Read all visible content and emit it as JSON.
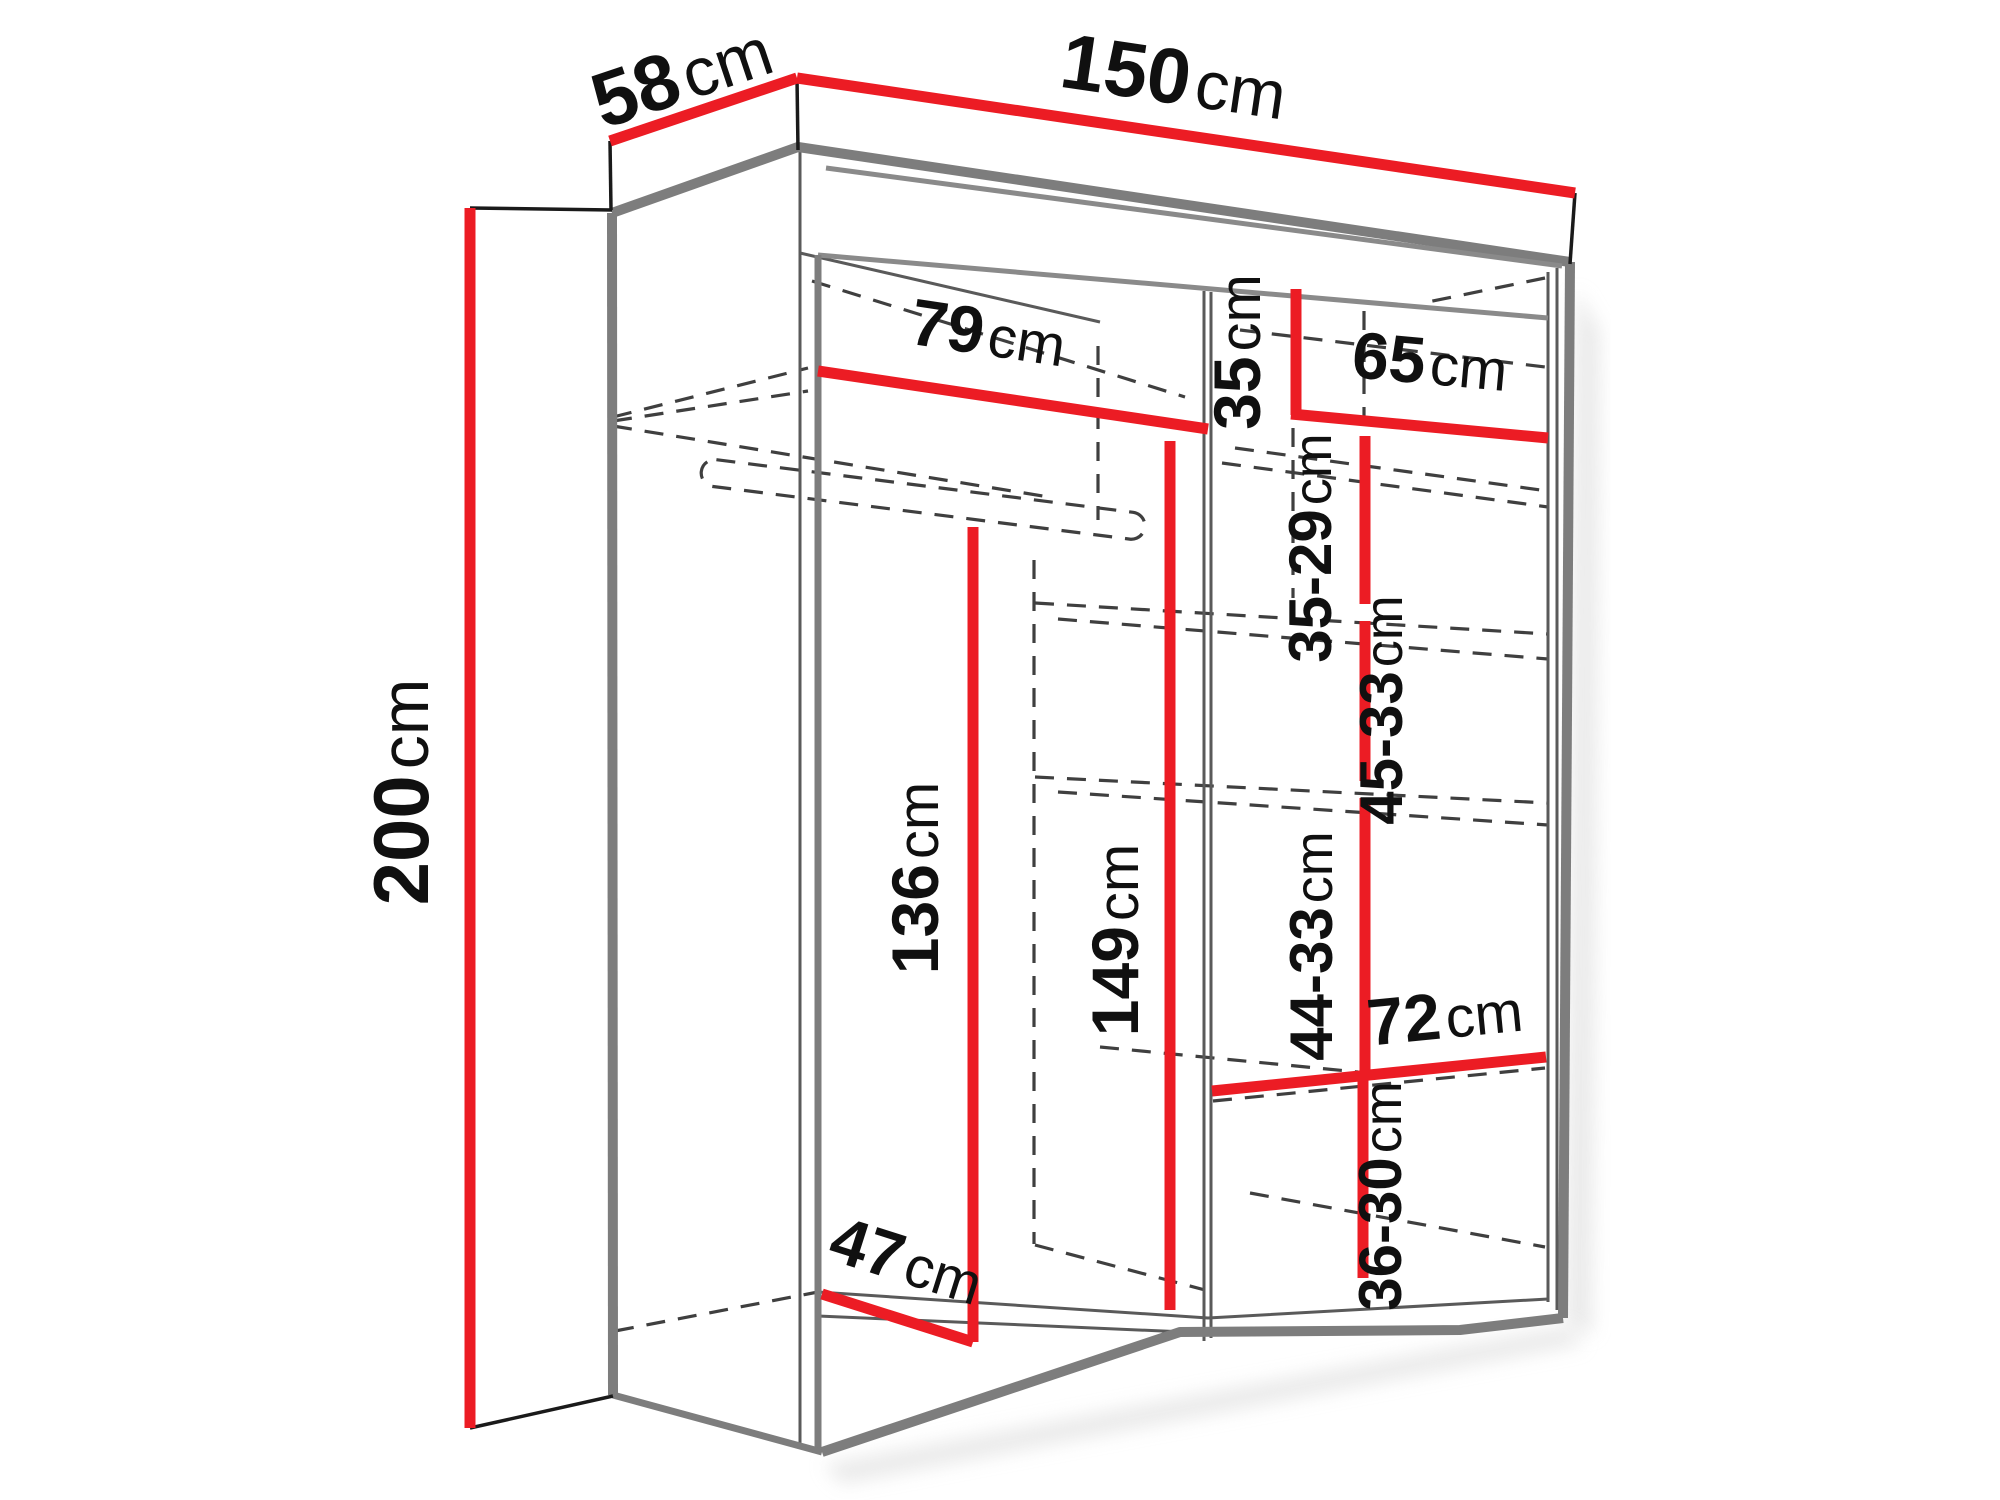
{
  "figure": {
    "type": "furniture-dimension-diagram",
    "subject": "two-door sliding wardrobe with interior shelf and hanging-rail dimensions",
    "background": "#ffffff"
  },
  "colors": {
    "dimension_line": "#ec1c24",
    "cabinet_edge": "#7d7d7d",
    "hidden_edge": "#3f3f3f",
    "text": "#101010"
  },
  "dims": {
    "depth58": {
      "value": "58",
      "unit": "cm"
    },
    "width150": {
      "value": "150",
      "unit": "cm"
    },
    "height200": {
      "value": "200",
      "unit": "cm"
    },
    "shelf79": {
      "value": "79",
      "unit": "cm"
    },
    "gap35": {
      "value": "35",
      "unit": "cm"
    },
    "shelf65": {
      "value": "65",
      "unit": "cm"
    },
    "gap3529": {
      "value": "35-29",
      "unit": "cm"
    },
    "gap4533": {
      "value": "45-33",
      "unit": "cm"
    },
    "gap4433": {
      "value": "44-33",
      "unit": "cm"
    },
    "shelf72": {
      "value": "72",
      "unit": "cm"
    },
    "gap3630": {
      "value": "36-30",
      "unit": "cm"
    },
    "height136": {
      "value": "136",
      "unit": "cm"
    },
    "height149": {
      "value": "149",
      "unit": "cm"
    },
    "depth47": {
      "value": "47",
      "unit": "cm"
    }
  }
}
